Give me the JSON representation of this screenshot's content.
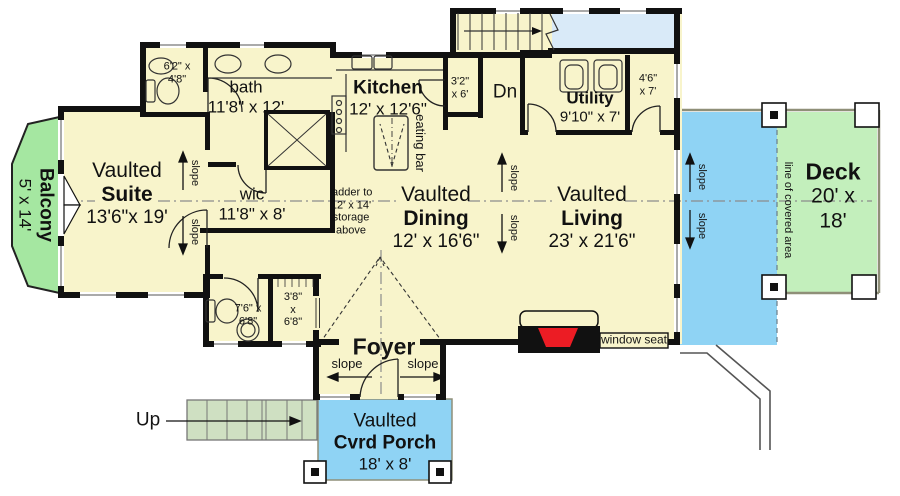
{
  "rooms": {
    "suite": {
      "prefix": "Vaulted",
      "name": "Suite",
      "dims": "13'6\"x 19'"
    },
    "balcony": {
      "name": "Balcony",
      "dims": "5' x 14'"
    },
    "bath": {
      "name": "bath",
      "dims": "11'8\" x 12'"
    },
    "powder_upper": {
      "dims_line1": "6'2\" x",
      "dims_line2": "4'8\""
    },
    "wic": {
      "name": "wic",
      "dims": "11'8\" x 8'"
    },
    "kitchen": {
      "name": "Kitchen",
      "dims": "12' x 12'6\""
    },
    "pantry": {
      "dims_line1": "3'2\"",
      "dims_line2": "x 6'"
    },
    "dining": {
      "prefix": "Vaulted",
      "name": "Dining",
      "dims": "12' x 16'6\""
    },
    "living": {
      "prefix": "Vaulted",
      "name": "Living",
      "dims": "23' x 21'6\""
    },
    "utility": {
      "name": "Utility",
      "dims": "9'10\" x 7'"
    },
    "utility_closet": {
      "dims_line1": "4'6\"",
      "dims_line2": "x 7'"
    },
    "powder_lower": {
      "dims_line1": "7'6\" x",
      "dims_line2": "6'8\""
    },
    "closet_lower": {
      "dims_line1": "3'8\"",
      "dims_line2": "x",
      "dims_line3": "6'8\""
    },
    "foyer": {
      "name": "Foyer"
    },
    "deck": {
      "name": "Deck",
      "dims": "20' x 18'"
    },
    "porch": {
      "prefix": "Vaulted",
      "name": "Cvrd Porch",
      "dims": "18' x 8'"
    }
  },
  "annotations": {
    "slope": "slope",
    "dn": "Dn",
    "up": "Up",
    "eating_bar": "eating bar",
    "window_seat": "window seat",
    "line_of_covered_area": "line of covered area",
    "ladder_line1": "ladder to",
    "ladder_line2": "12' x 14'",
    "ladder_line3": "storage",
    "ladder_line4": "above"
  },
  "colors": {
    "floor": "#F8F4CB",
    "wall": "#111111",
    "balcony_green": "#A5E7A1",
    "deck_green": "#C3EFBC",
    "covered_blue": "#8FD3F4",
    "landing_blue": "#D9EAF8",
    "steps_green": "#CFE0C2",
    "fireplace_red": "#EC1C24"
  }
}
